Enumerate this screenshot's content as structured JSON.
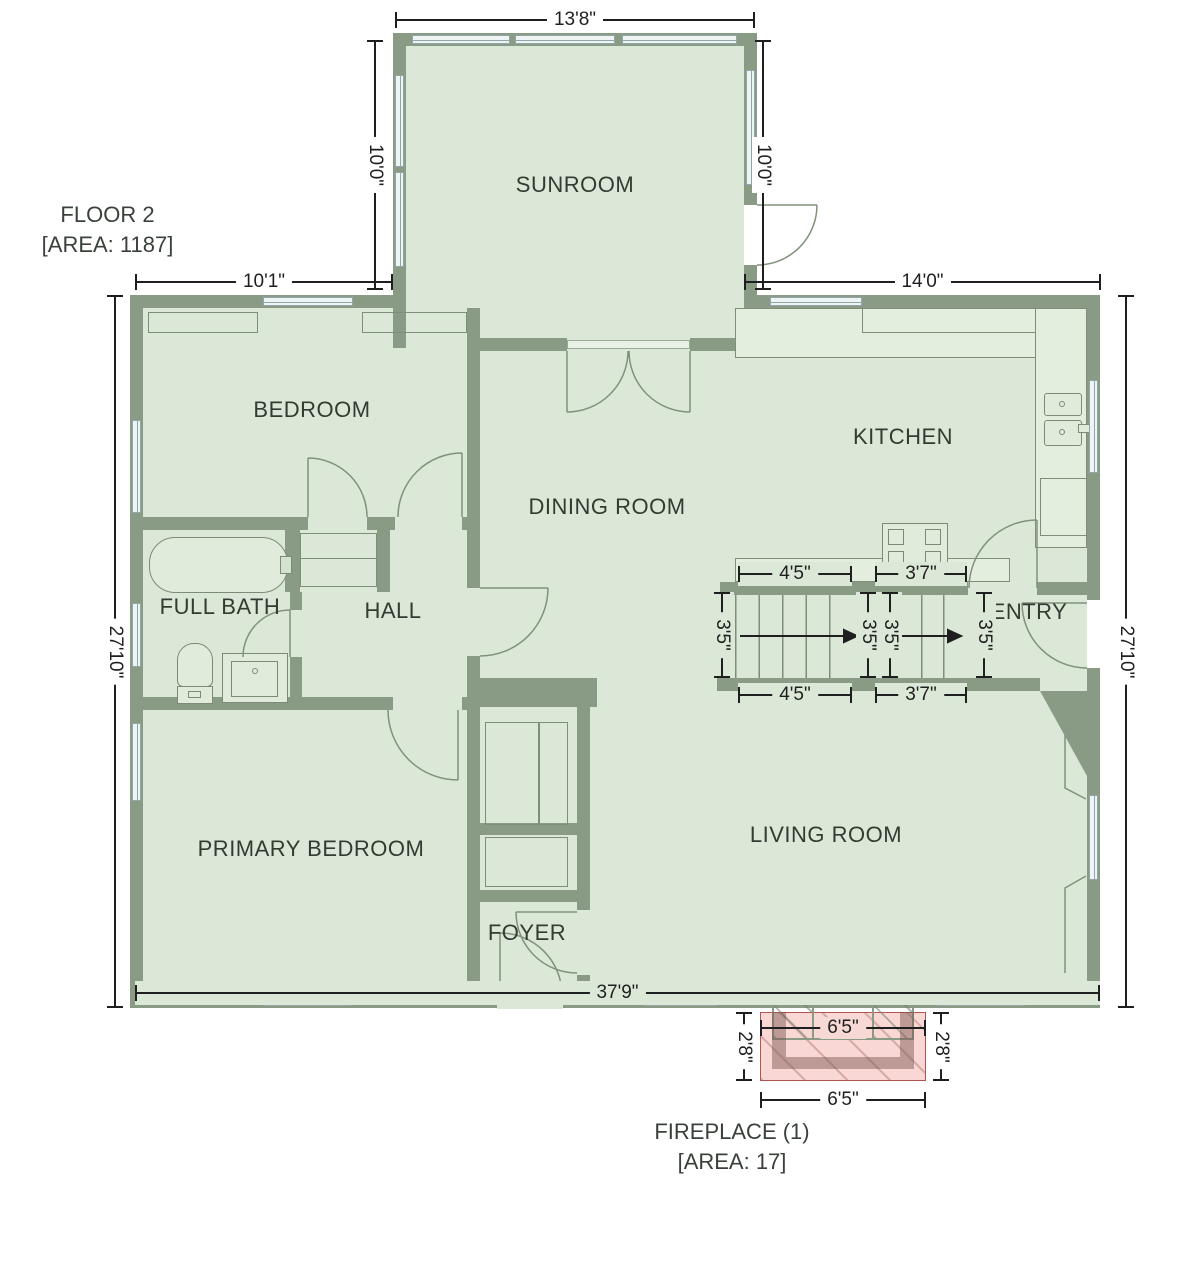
{
  "plan": {
    "title_line1": "FLOOR 2",
    "title_line2": "[AREA: 1187]",
    "fireplace_line1": "FIREPLACE (1)",
    "fireplace_line2": "[AREA: 17]"
  },
  "rooms": {
    "sunroom": "SUNROOM",
    "bedroom": "BEDROOM",
    "kitchen": "KITCHEN",
    "dining_room": "DINING ROOM",
    "full_bath": "FULL BATH",
    "hall": "HALL",
    "entry": "ENTRY",
    "primary_bedroom": "PRIMARY BEDROOM",
    "living_room": "LIVING ROOM",
    "foyer": "FOYER"
  },
  "dimensions": {
    "sunroom_width": "13'8\"",
    "sunroom_height_left": "10'0\"",
    "sunroom_height_right": "10'0\"",
    "bedroom_width": "10'1\"",
    "kitchen_width": "14'0\"",
    "house_height_left": "27'10\"",
    "house_height_right": "27'10\"",
    "stair_run1_top": "4'5\"",
    "stair_run2_top": "3'7\"",
    "stair_run1_bottom": "4'5\"",
    "stair_run2_bottom": "3'7\"",
    "stair_width_1": "3'5\"",
    "stair_width_2": "3'5\"",
    "stair_width_3": "3'5\"",
    "stair_width_4": "3'5\"",
    "house_width": "37'9\"",
    "fireplace_width_inner": "6'5\"",
    "fireplace_width_outer": "6'5\"",
    "fireplace_depth_left": "2'8\"",
    "fireplace_depth_right": "2'8\""
  },
  "colors": {
    "floor": "#dbe8d7",
    "wall": "#8a9b85",
    "outline": "#7e8e79",
    "window_fill": "#eef3f3",
    "fireplace_fill": "#f8d7d4",
    "fireplace_border": "#b2544f",
    "dimension": "#1f1f1f",
    "label": "#333b33"
  }
}
